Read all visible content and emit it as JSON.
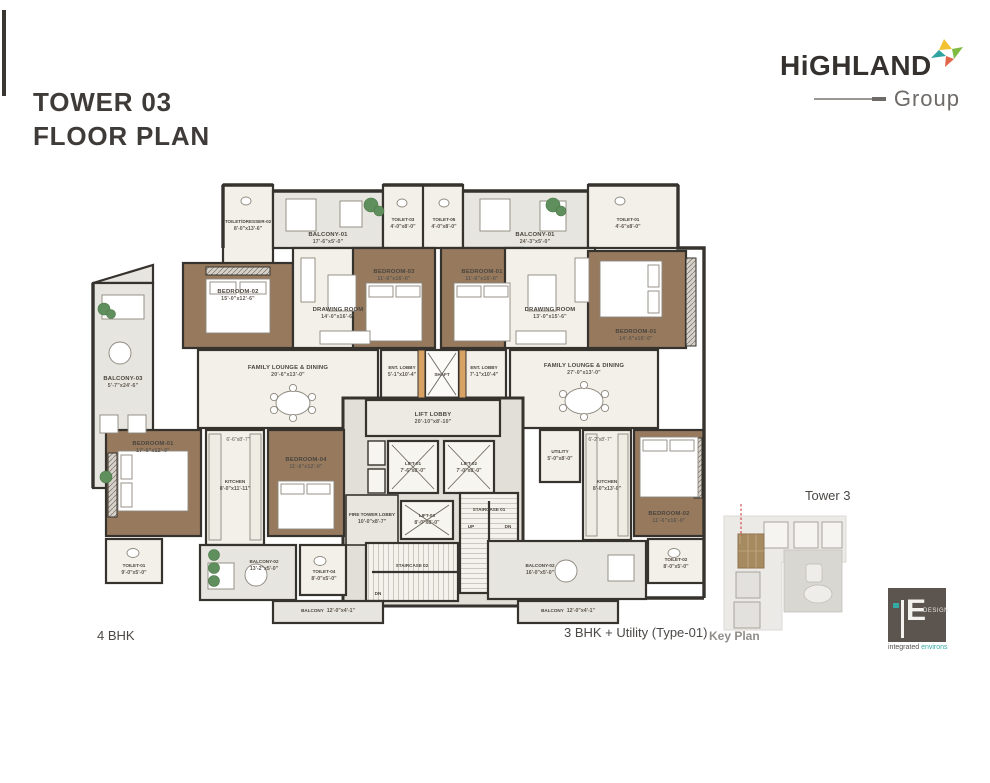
{
  "header": {
    "title_line1": "TOWER 03",
    "title_line2": "FLOOR PLAN"
  },
  "brand": {
    "name": "HiGHLAND",
    "sub": "Group"
  },
  "captions": {
    "left_unit": "4 BHK",
    "right_unit": "3 BHK + Utility (Type-01)"
  },
  "key_plan": {
    "tower_label": "Tower 3",
    "caption": "Key Plan"
  },
  "design_logo": {
    "monogram": "E",
    "name": "DESIGN",
    "tagline_1": "integrated",
    "tagline_2": "environs"
  },
  "colors": {
    "wall": "#36322d",
    "wood_floor": "#977a5e",
    "room_floor": "#f3f0e9",
    "balcony": "#e7e5df",
    "core": "#e2dfd8",
    "plant": "#5f8f5c",
    "wardrobe": "#d8a265",
    "tower_highlight": "#a78b60",
    "keyplan_dash": "#cc3333",
    "brand_yellow": "#f2c233",
    "brand_green": "#7fba42",
    "brand_teal": "#2fa3a0",
    "brand_orange": "#e2654a"
  },
  "plan": {
    "stairs": {
      "s1_up": "UP",
      "s1_dn": "DN",
      "s2_dn": "DN"
    },
    "rooms": [
      {
        "label": "TOILET/DRESSER-02",
        "dims": "8'-0\"x13'-6\""
      },
      {
        "label": "BALCONY-01",
        "dims": "17'-6\"x5'-0\""
      },
      {
        "label": "TOILET-03",
        "dims": "4'-0\"x8'-0\""
      },
      {
        "label": "TOILET-05",
        "dims": "4'-0\"x8'-0\""
      },
      {
        "label": "BALCONY-01",
        "dims": "24'-3\"x5'-0\""
      },
      {
        "label": "TOILET-01",
        "dims": "4'-6\"x8'-0\""
      },
      {
        "label": "BEDROOM-02",
        "dims": "15'-0\"x12'-6\""
      },
      {
        "label": "DRAWING ROOM",
        "dims": "14'-0\"x16'-6\""
      },
      {
        "label": "BEDROOM-03",
        "dims": "11'-6\"x16'-0\""
      },
      {
        "label": "BEDROOM-01",
        "dims": "11'-6\"x16'-0\""
      },
      {
        "label": "DRAWING ROOM",
        "dims": "13'-0\"x15'-6\""
      },
      {
        "label": "BEDROOM-01",
        "dims": "14'-0\"x16'-0\""
      },
      {
        "label": "BALCONY-03",
        "dims": "5'-7\"x24'-6\""
      },
      {
        "label": "FAMILY LOUNGE & DINING",
        "dims": "20'-6\"x13'-0\""
      },
      {
        "label": "ENT. LOBBY",
        "dims": "5'-1\"x10'-4\""
      },
      {
        "label": "SHAFT",
        "dims": ""
      },
      {
        "label": "ENT. LOBBY",
        "dims": "7'-1\"x10'-4\""
      },
      {
        "label": "FAMILY LOUNGE & DINING",
        "dims": "27'-0\"x13'-0\""
      },
      {
        "label": "LIFT LOBBY",
        "dims": "20'-10\"x8'-10\""
      },
      {
        "label": "LIFT-01",
        "dims": "7'-6\"x8'-0\""
      },
      {
        "label": "LIFT-02",
        "dims": "7'-0\"x8'-0\""
      },
      {
        "label": "LIFT-03",
        "dims": "8'-0\"x8'-0\""
      },
      {
        "label": "FIRE TOWER LOBBY",
        "dims": "10'-0\"x8'-7\""
      },
      {
        "label": "STAIRCASE 01",
        "dims": ""
      },
      {
        "label": "STAIRCASE 02",
        "dims": ""
      },
      {
        "label": "BEDROOM-01",
        "dims": "17'-6\"x12'-0\""
      },
      {
        "label": "KITCHEN",
        "dims": "8'-0\"x11'-11\""
      },
      {
        "label": "BEDROOM-04",
        "dims": "11'-6\"x12'-0\""
      },
      {
        "label": "TOILET-01",
        "dims": "9'-0\"x5'-0\""
      },
      {
        "label": "BALCONY-02",
        "dims": "13'-2\"x5'-0\""
      },
      {
        "label": "TOILET-04",
        "dims": "8'-0\"x5'-0\""
      },
      {
        "label": "BALCONY",
        "dims": "12'-0\"x4'-1\""
      },
      {
        "label": "UTILITY",
        "dims": "5'-0\"x8'-0\""
      },
      {
        "label": "KITCHEN",
        "dims": "8'-0\"x13'-0\""
      },
      {
        "label": "BEDROOM-02",
        "dims": "11'-6\"x16'-0\""
      },
      {
        "label": "TOILET-02",
        "dims": "8'-0\"x5'-0\""
      },
      {
        "label": "BALCONY-02",
        "dims": "16'-0\"x5'-0\""
      },
      {
        "label": "BALCONY",
        "dims": "12'-0\"x4'-1\""
      },
      {
        "label": "6'-6\"x8'-7\"",
        "dims": ""
      },
      {
        "label": "6'-2\"x8'-7\"",
        "dims": ""
      }
    ]
  }
}
